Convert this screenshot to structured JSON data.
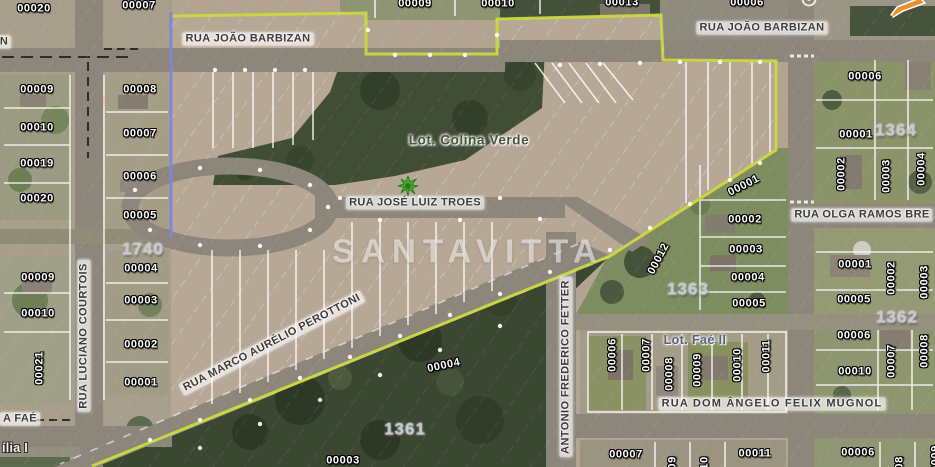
{
  "map": {
    "watermark": {
      "text": "SANTAVITTA",
      "subtext": "· · · · · · · ·"
    },
    "colors": {
      "boundary_green": "#c9d93f",
      "boundary_purple": "#7f85d6",
      "marker_orange": "#e8912c",
      "tree_marker_green": "#49b22a",
      "block_number_gray": "#c9c7ce"
    },
    "icons": [
      {
        "name": "tree-marker-icon"
      },
      {
        "name": "edit-pencil-icon"
      },
      {
        "name": "utility-circle-icon"
      }
    ],
    "labels": [
      {
        "name": "lot-label-00020-top",
        "text": "00020",
        "x": 34,
        "y": 9,
        "rot": 0,
        "cls": "lot"
      },
      {
        "name": "lot-label-00007-top",
        "text": "00007",
        "x": 139,
        "y": 6,
        "rot": 0,
        "cls": "lot"
      },
      {
        "name": "lot-label-00009-top",
        "text": "00009",
        "x": 415,
        "y": 4,
        "rot": 0,
        "cls": "lot"
      },
      {
        "name": "lot-label-00010-top",
        "text": "00010",
        "x": 498,
        "y": 4,
        "rot": 0,
        "cls": "lot"
      },
      {
        "name": "lot-label-00013-top",
        "text": "00013",
        "x": 622,
        "y": 3,
        "rot": 0,
        "cls": "lot"
      },
      {
        "name": "lot-label-00006-top",
        "text": "00006",
        "x": 747,
        "y": 3,
        "rot": 0,
        "cls": "lot"
      },
      {
        "name": "street-label-rua-joao-barbizan-left",
        "text": "RUA JOÃO BARBIZAN",
        "x": 248,
        "y": 39,
        "rot": 0,
        "cls": "street"
      },
      {
        "name": "street-label-rua-joao-barbizan-right",
        "text": "RUA JOÃO BARBIZAN",
        "x": 762,
        "y": 28,
        "rot": 0,
        "cls": "street"
      },
      {
        "name": "street-label-rua-jose-luiz-troes",
        "text": "RUA JOSÉ LUIZ TROES",
        "x": 415,
        "y": 203,
        "rot": 0,
        "cls": "street"
      },
      {
        "name": "street-label-rua-luciano-courtois",
        "text": "RUA LUCIANO COURTOIS",
        "x": 84,
        "y": 336,
        "rot": -90,
        "cls": "street"
      },
      {
        "name": "street-label-antonio-frederico-fetter",
        "text": "ANTONIO FREDERICO FETTER",
        "x": 566,
        "y": 367,
        "rot": -90,
        "cls": "street"
      },
      {
        "name": "street-label-rua-olga-ramos-bre",
        "text": "RUA OLGA RAMOS BRE",
        "x": 862,
        "y": 215,
        "rot": 0,
        "cls": "street"
      },
      {
        "name": "street-label-rua-dom-angelo-felix-mugnol",
        "text": "RUA DOM ÂNGELO FELIX MUGNOL",
        "x": 772,
        "y": 404,
        "rot": 0,
        "cls": "street street-wide"
      },
      {
        "name": "street-label-rua-marco-aurelio-perottoni",
        "text": "RUA MARCO AURÉLIO PEROTTONI",
        "x": 272,
        "y": 343,
        "rot": -27.5,
        "cls": "street"
      },
      {
        "name": "street-label-fae-fragment",
        "text": "A FAÉ",
        "x": 20,
        "y": 419,
        "rot": 0,
        "cls": "street-frag"
      },
      {
        "name": "street-label-n-fragment",
        "text": "N",
        "x": 4,
        "y": 42,
        "rot": 0,
        "cls": "street-frag"
      },
      {
        "name": "lot-label-00009-w1",
        "text": "00009",
        "x": 37,
        "y": 90,
        "rot": 0,
        "cls": "lot"
      },
      {
        "name": "lot-label-00008-w",
        "text": "00008",
        "x": 140,
        "y": 90,
        "rot": 0,
        "cls": "lot"
      },
      {
        "name": "lot-label-00010-w1",
        "text": "00010",
        "x": 37,
        "y": 128,
        "rot": 0,
        "cls": "lot"
      },
      {
        "name": "lot-label-00007-w",
        "text": "00007",
        "x": 140,
        "y": 134,
        "rot": 0,
        "cls": "lot"
      },
      {
        "name": "lot-label-00019-w",
        "text": "00019",
        "x": 37,
        "y": 164,
        "rot": 0,
        "cls": "lot"
      },
      {
        "name": "lot-label-00006-w",
        "text": "00006",
        "x": 140,
        "y": 177,
        "rot": 0,
        "cls": "lot"
      },
      {
        "name": "lot-label-00020-w",
        "text": "00020",
        "x": 37,
        "y": 199,
        "rot": 0,
        "cls": "lot"
      },
      {
        "name": "lot-label-00005-w",
        "text": "00005",
        "x": 140,
        "y": 216,
        "rot": 0,
        "cls": "lot"
      },
      {
        "name": "block-label-1740",
        "text": "1740",
        "x": 143,
        "y": 249,
        "rot": 0,
        "cls": "block"
      },
      {
        "name": "lot-label-00004-w",
        "text": "00004",
        "x": 141,
        "y": 269,
        "rot": 0,
        "cls": "lot"
      },
      {
        "name": "lot-label-00009-w2",
        "text": "00009",
        "x": 38,
        "y": 278,
        "rot": 0,
        "cls": "lot"
      },
      {
        "name": "lot-label-00003-w",
        "text": "00003",
        "x": 141,
        "y": 301,
        "rot": 0,
        "cls": "lot"
      },
      {
        "name": "lot-label-00010-w2",
        "text": "00010",
        "x": 38,
        "y": 314,
        "rot": 0,
        "cls": "lot"
      },
      {
        "name": "lot-label-00002-w",
        "text": "00002",
        "x": 141,
        "y": 345,
        "rot": 0,
        "cls": "lot"
      },
      {
        "name": "lot-label-00021-w",
        "text": "00021",
        "x": 40,
        "y": 368,
        "rot": -90,
        "cls": "lot"
      },
      {
        "name": "lot-label-00001-w",
        "text": "00001",
        "x": 141,
        "y": 383,
        "rot": 0,
        "cls": "lot"
      },
      {
        "name": "place-label-ilia-i",
        "text": "ília I",
        "x": 15,
        "y": 448,
        "rot": 0,
        "cls": "place"
      },
      {
        "name": "lotname-label-colina-verde",
        "text": "Lot. Colina Verde",
        "x": 469,
        "y": 140,
        "rot": 0,
        "cls": "lotname-olive"
      },
      {
        "name": "lot-label-00001-1363",
        "text": "00001",
        "x": 744,
        "y": 186,
        "rot": -27,
        "cls": "lot"
      },
      {
        "name": "lot-label-00002-1363",
        "text": "00002",
        "x": 745,
        "y": 220,
        "rot": 0,
        "cls": "lot"
      },
      {
        "name": "lot-label-00012-1363",
        "text": "00012",
        "x": 659,
        "y": 259,
        "rot": -62,
        "cls": "lot"
      },
      {
        "name": "lot-label-00003-1363",
        "text": "00003",
        "x": 746,
        "y": 250,
        "rot": 0,
        "cls": "lot"
      },
      {
        "name": "block-label-1363",
        "text": "1363",
        "x": 688,
        "y": 289,
        "rot": 0,
        "cls": "block"
      },
      {
        "name": "lot-label-00004-1363",
        "text": "00004",
        "x": 748,
        "y": 278,
        "rot": 0,
        "cls": "lot"
      },
      {
        "name": "lot-label-00005-1363",
        "text": "00005",
        "x": 749,
        "y": 304,
        "rot": 0,
        "cls": "lot"
      },
      {
        "name": "lot-label-00006-1364",
        "text": "00006",
        "x": 865,
        "y": 77,
        "rot": 0,
        "cls": "lot"
      },
      {
        "name": "lot-label-00001-1364",
        "text": "00001",
        "x": 856,
        "y": 135,
        "rot": 0,
        "cls": "lot"
      },
      {
        "name": "block-label-1364",
        "text": "1364",
        "x": 896,
        "y": 130,
        "rot": 0,
        "cls": "block"
      },
      {
        "name": "lot-label-00002-1364",
        "text": "00002",
        "x": 842,
        "y": 174,
        "rot": -90,
        "cls": "lot"
      },
      {
        "name": "lot-label-00003-1364",
        "text": "00003",
        "x": 887,
        "y": 176,
        "rot": -90,
        "cls": "lot"
      },
      {
        "name": "lot-label-00004-1364",
        "text": "00004",
        "x": 922,
        "y": 169,
        "rot": -90,
        "cls": "lot"
      },
      {
        "name": "lot-label-00001-e",
        "text": "00001",
        "x": 855,
        "y": 265,
        "rot": 0,
        "cls": "lot"
      },
      {
        "name": "lot-label-00002-e",
        "text": "00002",
        "x": 892,
        "y": 278,
        "rot": -90,
        "cls": "lot"
      },
      {
        "name": "lot-label-00003-e",
        "text": "00003",
        "x": 925,
        "y": 282,
        "rot": -90,
        "cls": "lot"
      },
      {
        "name": "lot-label-00005-e",
        "text": "00005",
        "x": 854,
        "y": 300,
        "rot": 0,
        "cls": "lot"
      },
      {
        "name": "block-label-1362",
        "text": "1362",
        "x": 897,
        "y": 317,
        "rot": 0,
        "cls": "block"
      },
      {
        "name": "lot-label-00006-1362",
        "text": "00006",
        "x": 854,
        "y": 336,
        "rot": 0,
        "cls": "lot"
      },
      {
        "name": "lot-label-00007-1362",
        "text": "00007",
        "x": 892,
        "y": 361,
        "rot": -90,
        "cls": "lot"
      },
      {
        "name": "lot-label-00008-1362",
        "text": "00008",
        "x": 925,
        "y": 351,
        "rot": -90,
        "cls": "lot"
      },
      {
        "name": "lot-label-00010-1362",
        "text": "00010",
        "x": 855,
        "y": 372,
        "rot": 0,
        "cls": "lot"
      },
      {
        "name": "lot-label-00006-fae",
        "text": "00006",
        "x": 613,
        "y": 355,
        "rot": -90,
        "cls": "lot"
      },
      {
        "name": "lot-label-00007-fae",
        "text": "00007",
        "x": 647,
        "y": 355,
        "rot": -90,
        "cls": "lot"
      },
      {
        "name": "lotname-label-fae-ii",
        "text": "Lot. Faé II",
        "x": 695,
        "y": 340,
        "rot": 0,
        "cls": "lotname-blue"
      },
      {
        "name": "lot-label-00008-fae",
        "text": "00008",
        "x": 670,
        "y": 374,
        "rot": -90,
        "cls": "lot"
      },
      {
        "name": "lot-label-00009-fae",
        "text": "00009",
        "x": 698,
        "y": 370,
        "rot": -90,
        "cls": "lot"
      },
      {
        "name": "lot-label-00010-fae",
        "text": "00010",
        "x": 738,
        "y": 365,
        "rot": -90,
        "cls": "lot"
      },
      {
        "name": "lot-label-00011-fae",
        "text": "00011",
        "x": 767,
        "y": 356,
        "rot": -90,
        "cls": "lot"
      },
      {
        "name": "lot-label-00004-forest",
        "text": "00004",
        "x": 444,
        "y": 366,
        "rot": -12,
        "cls": "lot"
      },
      {
        "name": "block-label-1361",
        "text": "1361",
        "x": 405,
        "y": 429,
        "rot": 0,
        "cls": "block"
      },
      {
        "name": "lot-label-00003-forest",
        "text": "00003",
        "x": 343,
        "y": 461,
        "rot": 0,
        "cls": "lot"
      },
      {
        "name": "lot-label-00007-s",
        "text": "00007",
        "x": 626,
        "y": 455,
        "rot": 0,
        "cls": "lot"
      },
      {
        "name": "lot-label-00009-s",
        "text": "00009",
        "x": 673,
        "y": 473,
        "rot": -90,
        "cls": "lot"
      },
      {
        "name": "lot-label-00010-s",
        "text": "00010",
        "x": 705,
        "y": 473,
        "rot": -90,
        "cls": "lot"
      },
      {
        "name": "lot-label-00011-s",
        "text": "00011",
        "x": 755,
        "y": 454,
        "rot": 0,
        "cls": "lot"
      },
      {
        "name": "lot-label-00006-s",
        "text": "00006",
        "x": 858,
        "y": 453,
        "rot": 0,
        "cls": "lot"
      },
      {
        "name": "lot-label-00008-s",
        "text": "00008",
        "x": 900,
        "y": 473,
        "rot": -90,
        "cls": "lot"
      },
      {
        "name": "lot-label-00009-edge",
        "text": "00009",
        "x": 936,
        "y": 462,
        "rot": -90,
        "cls": "lot"
      }
    ]
  }
}
